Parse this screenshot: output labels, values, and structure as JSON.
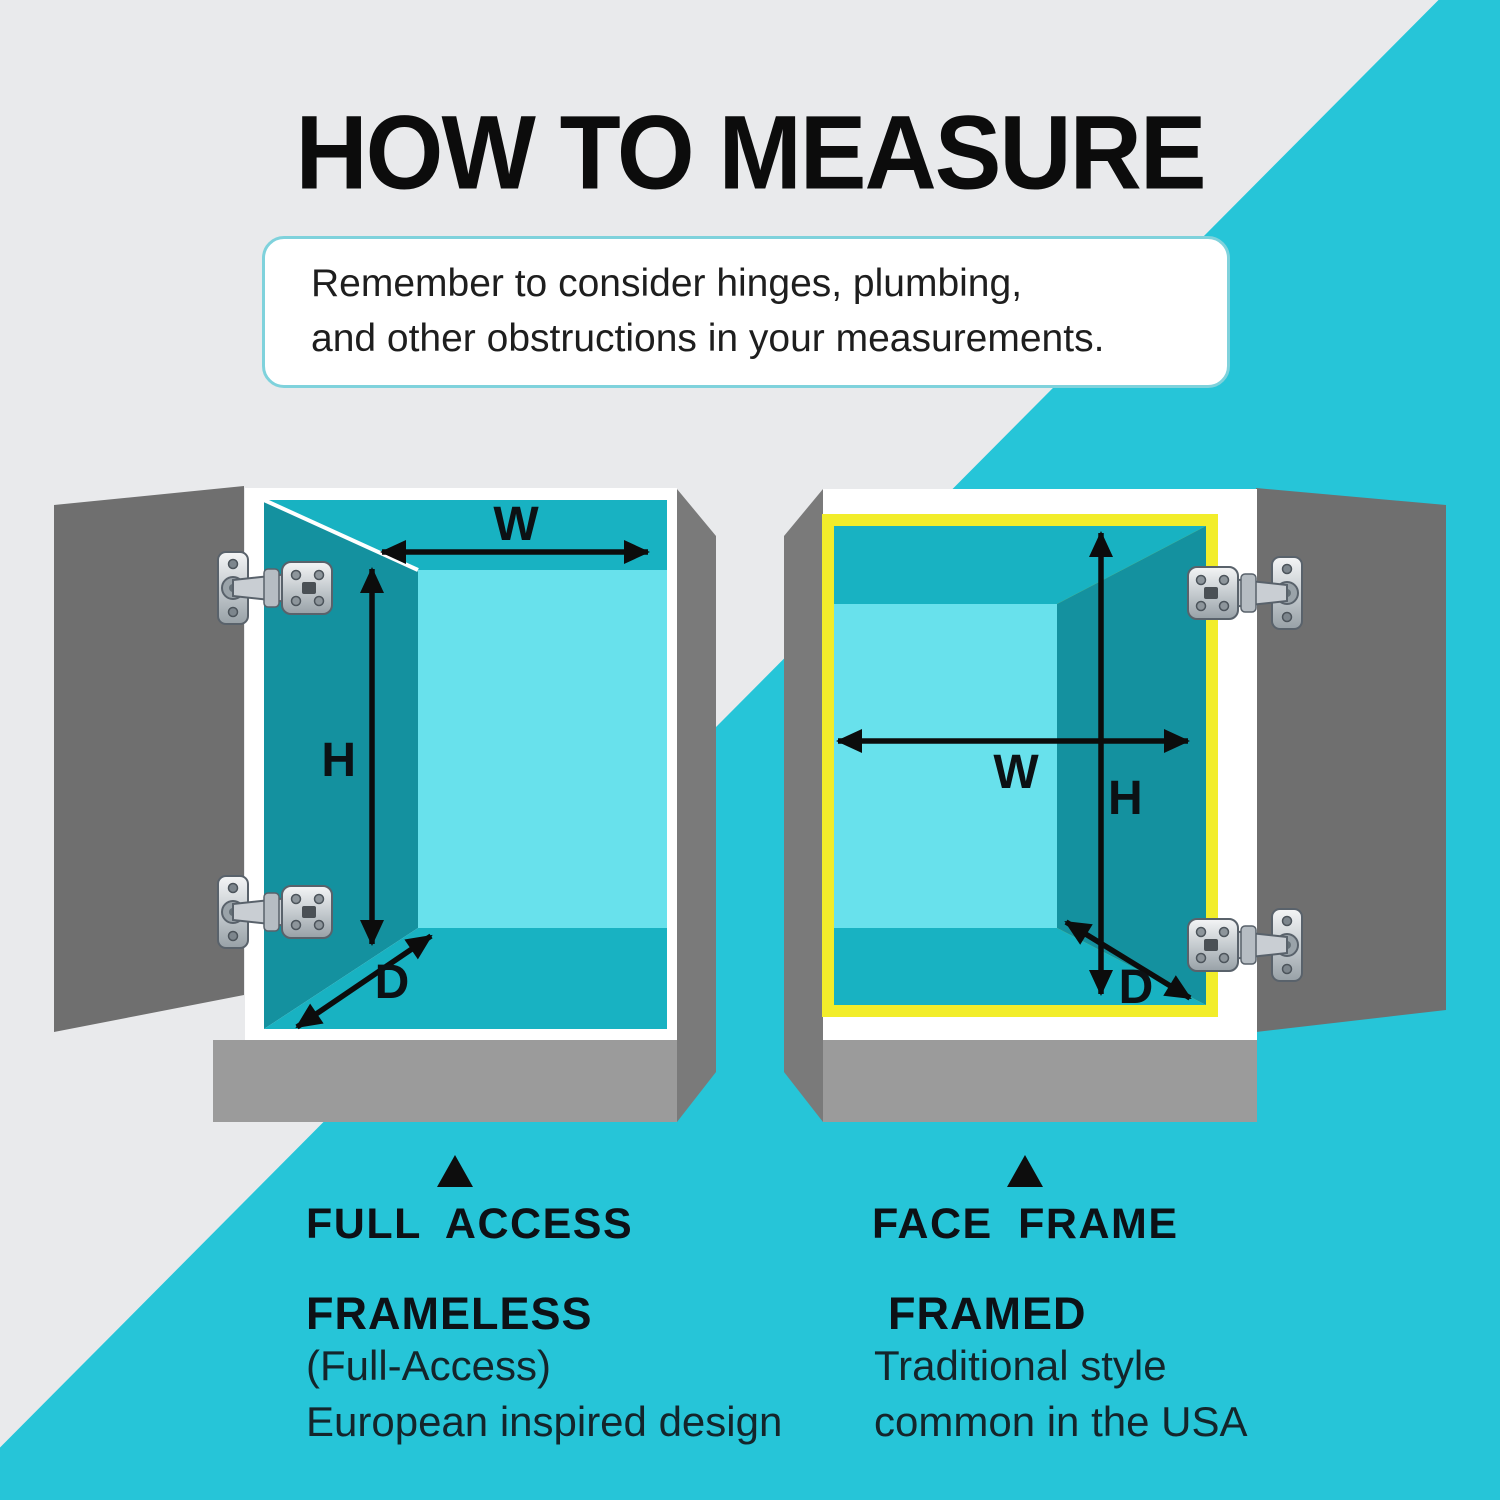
{
  "title": "HOW TO MEASURE",
  "note": {
    "line1": "Remember to consider hinges, plumbing,",
    "line2": "and other obstructions in your measurements."
  },
  "cabinets": {
    "left": {
      "type_label": "FULL ACCESS",
      "style_label": "FRAMELESS",
      "description_line1": "(Full-Access)",
      "description_line2": "European inspired design",
      "width_label": "W",
      "height_label": "H",
      "depth_label": "D"
    },
    "right": {
      "type_label": "FACE FRAME",
      "style_label": "FRAMED",
      "description_line1": "Traditional style",
      "description_line2": "common in the USA",
      "width_label": "W",
      "height_label": "H",
      "depth_label": "D"
    }
  },
  "colors": {
    "background_gray": "#e9eaec",
    "accent_teal": "#26c5d8",
    "interior_wall_dark": "#14919f",
    "interior_ceiling_floor": "#18b2c2",
    "interior_back_panel": "#68e1ec",
    "face_frame_yellow": "#f2ed2a",
    "door_gray": "#6f6f6f",
    "base_gray": "#9b9b9b",
    "note_border": "#7fd2dc",
    "text_black": "#0d0d0d"
  }
}
